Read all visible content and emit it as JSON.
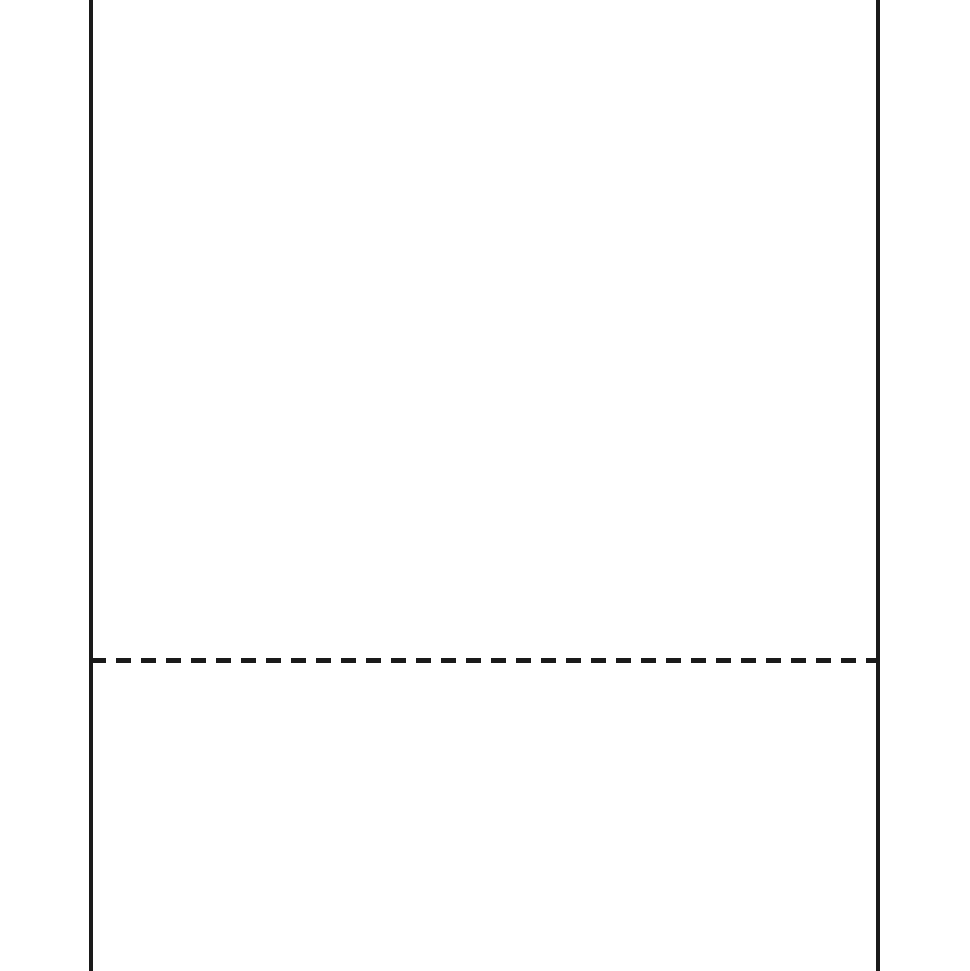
{
  "colors": {
    "background": "#ffffff",
    "line": "#1a1a1a"
  },
  "graphics": {
    "left_edge": "solid-vertical-line",
    "right_edge": "solid-vertical-line",
    "perforation": "dashed-horizontal-line"
  }
}
